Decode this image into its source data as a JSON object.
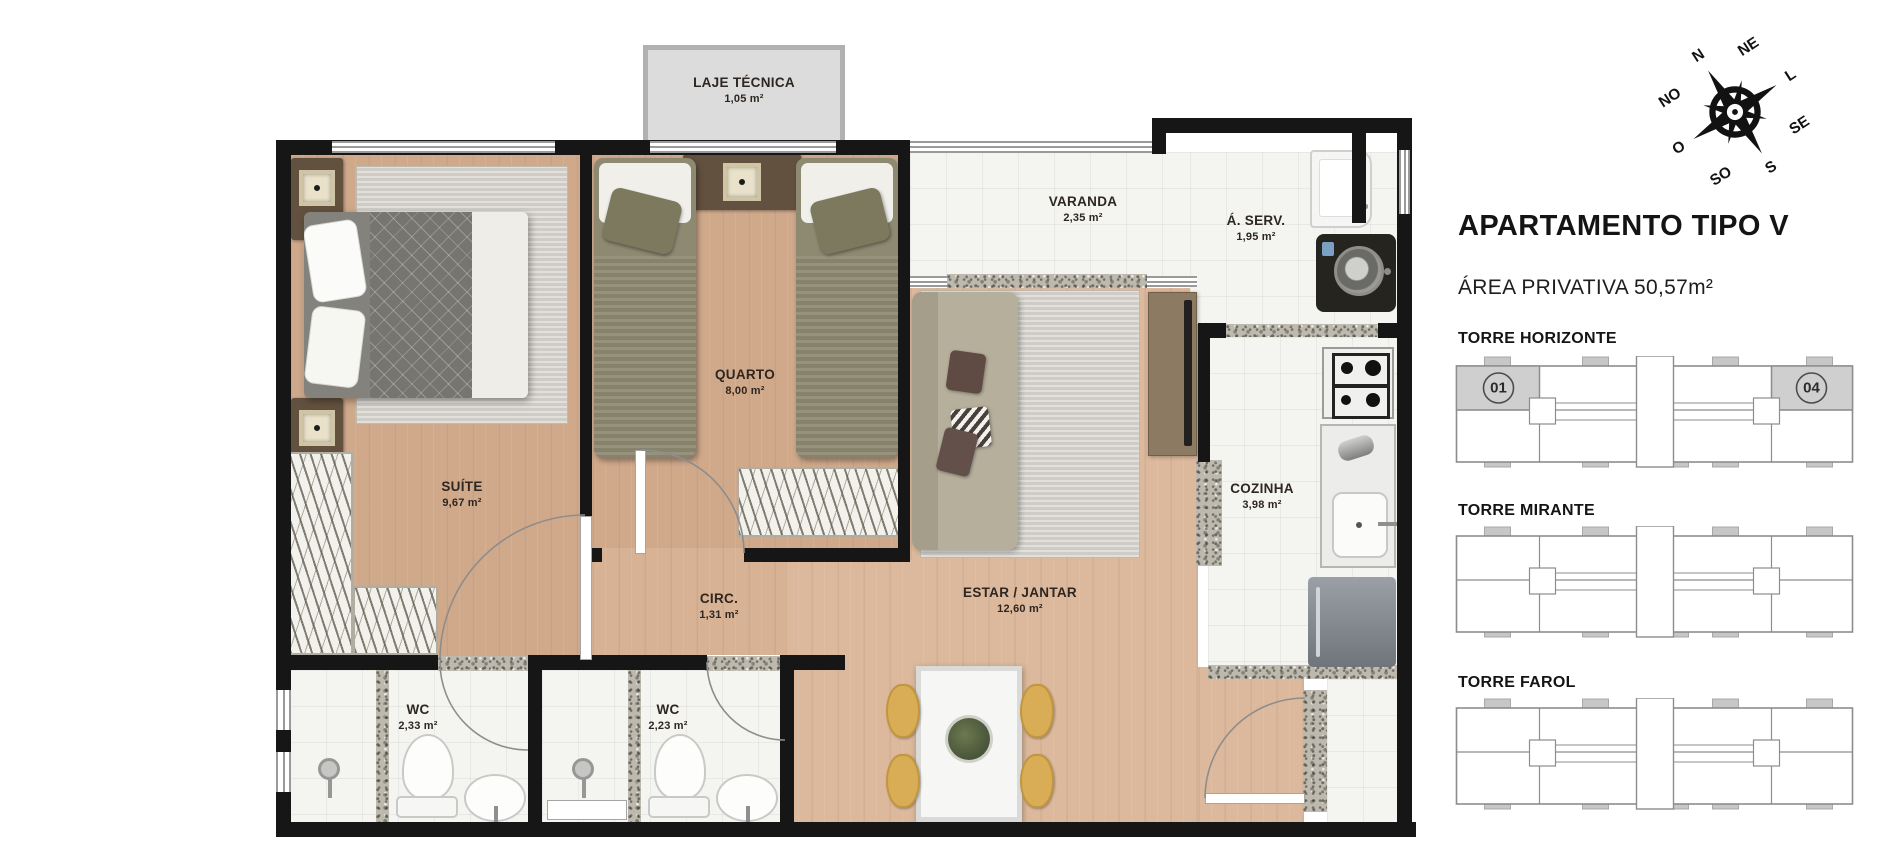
{
  "plan": {
    "rooms": {
      "laje": {
        "name": "LAJE TÉCNICA",
        "area": "1,05 m²"
      },
      "varanda": {
        "name": "VARANDA",
        "area": "2,35 m²"
      },
      "aserv": {
        "name": "Á. SERV.",
        "area": "1,95 m²"
      },
      "quarto": {
        "name": "QUARTO",
        "area": "8,00 m²"
      },
      "suite": {
        "name": "SUÍTE",
        "area": "9,67 m²"
      },
      "circ": {
        "name": "CIRC.",
        "area": "1,31 m²"
      },
      "estar": {
        "name": "ESTAR / JANTAR",
        "area": "12,60 m²"
      },
      "cozinha": {
        "name": "COZINHA",
        "area": "3,98 m²"
      },
      "wc1": {
        "name": "WC",
        "area": "2,33 m²"
      },
      "wc2": {
        "name": "WC",
        "area": "2,23 m²"
      }
    }
  },
  "panel": {
    "title": "APARTAMENTO TIPO V",
    "subtitle": "ÁREA PRIVATIVA 50,57m²",
    "towers": [
      {
        "name": "TORRE HORIZONTE",
        "unit_left": "01",
        "unit_right": "04"
      },
      {
        "name": "TORRE MIRANTE"
      },
      {
        "name": "TORRE FAROL"
      }
    ]
  },
  "compass": {
    "labels": [
      "N",
      "NE",
      "L",
      "SE",
      "S",
      "SO",
      "O",
      "NO"
    ]
  },
  "colors": {
    "wall": "#161616",
    "wood_floor": "#d7b294",
    "tile_floor": "#f4f4f1",
    "highlight_unit_gray": "#cfcfcf",
    "chair_yellow": "#d8ad55",
    "laje_gray": "#dcdcdc"
  }
}
